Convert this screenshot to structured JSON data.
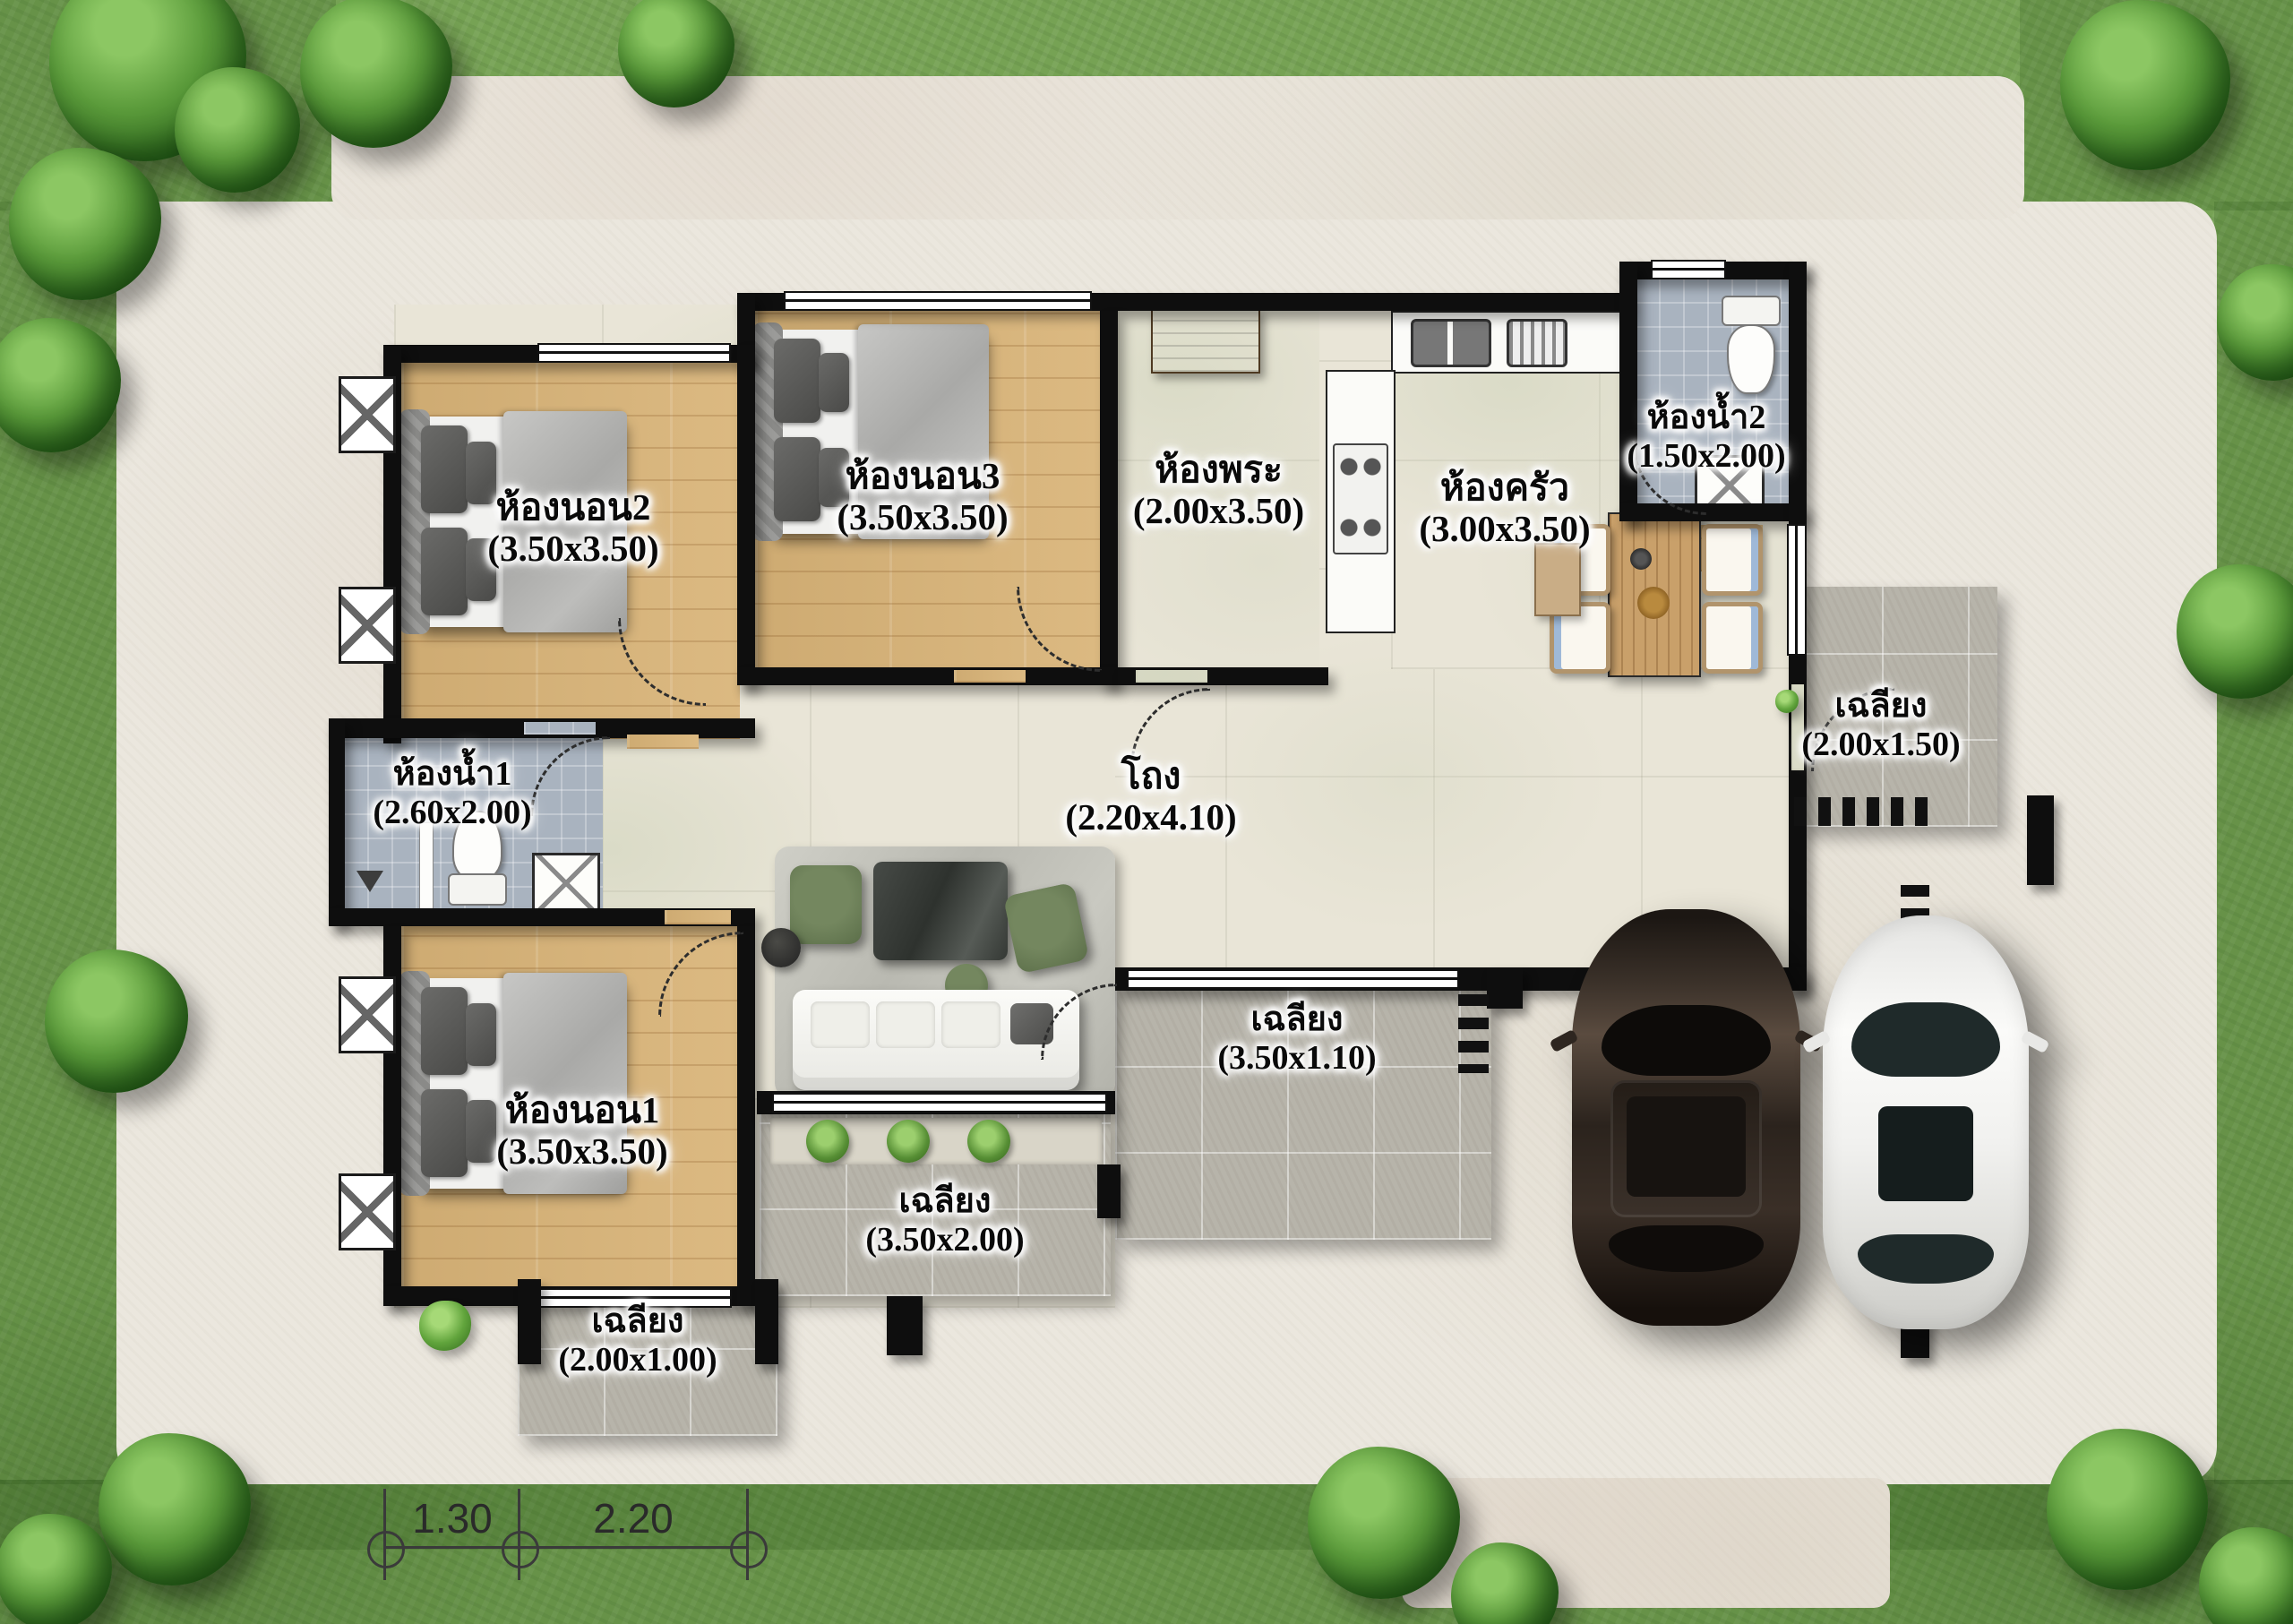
{
  "plan": {
    "rooms": [
      {
        "id": "bedroom-2",
        "name": "ห้องนอน2",
        "dims": "(3.50x3.50)"
      },
      {
        "id": "bedroom-3",
        "name": "ห้องนอน3",
        "dims": "(3.50x3.50)"
      },
      {
        "id": "prayer-room",
        "name": "ห้องพระ",
        "dims": "(2.00x3.50)"
      },
      {
        "id": "kitchen",
        "name": "ห้องครัว",
        "dims": "(3.00x3.50)"
      },
      {
        "id": "bathroom-2",
        "name": "ห้องน้ำ2",
        "dims": "(1.50x2.00)"
      },
      {
        "id": "bathroom-1",
        "name": "ห้องน้ำ1",
        "dims": "(2.60x2.00)"
      },
      {
        "id": "hall",
        "name": "โถง",
        "dims": "(2.20x4.10)"
      },
      {
        "id": "bedroom-1",
        "name": "ห้องนอน1",
        "dims": "(3.50x3.50)"
      },
      {
        "id": "porch-right",
        "name": "เฉลียง",
        "dims": "(2.00x1.50)"
      },
      {
        "id": "porch-middle",
        "name": "เฉลียง",
        "dims": "(3.50x1.10)"
      },
      {
        "id": "porch-living",
        "name": "เฉลียง",
        "dims": "(3.50x2.00)"
      },
      {
        "id": "porch-bottom",
        "name": "เฉลียง",
        "dims": "(2.00x1.00)"
      }
    ],
    "dimension_line": {
      "segment1": "1.30",
      "segment2": "2.20"
    },
    "colors": {
      "grass": "#76a254",
      "paving": "#ebe7de",
      "wood_floor": "#d9b478",
      "interior_tile": "#e9e5d7",
      "bathroom_tile": "#a9b3bf",
      "porch_tile": "#b7b4aa",
      "wall": "#0e0e0e",
      "car_dark": "#3c322a",
      "car_white": "#f4f4f2"
    }
  }
}
